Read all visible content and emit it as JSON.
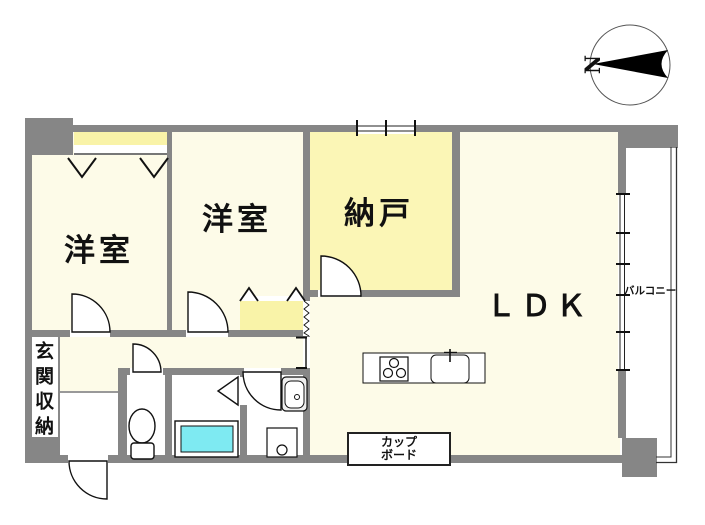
{
  "plan": {
    "type": "floor-plan",
    "compass": {
      "north_label": "N"
    },
    "rooms": {
      "bedroom1": "洋室",
      "bedroom2": "洋室",
      "storage_room": "納戸",
      "ldk": "ＬＤＫ",
      "balcony": "バルコニー",
      "entrance_storage": "玄関収納",
      "cupboard_line1": "カップ",
      "cupboard_line2": "ボード"
    },
    "fixtures": [
      "toilet",
      "bathtub",
      "washing-machine",
      "washbasin",
      "stove",
      "kitchen-sink"
    ],
    "colors": {
      "wall": "#868686",
      "room_fill": "#FDFBE8",
      "closet_fill": "#F9F3A8",
      "storage_fill": "#FBF6B6",
      "bathtub_fill": "#7EEAF2",
      "background": "#FFFFFF"
    }
  }
}
